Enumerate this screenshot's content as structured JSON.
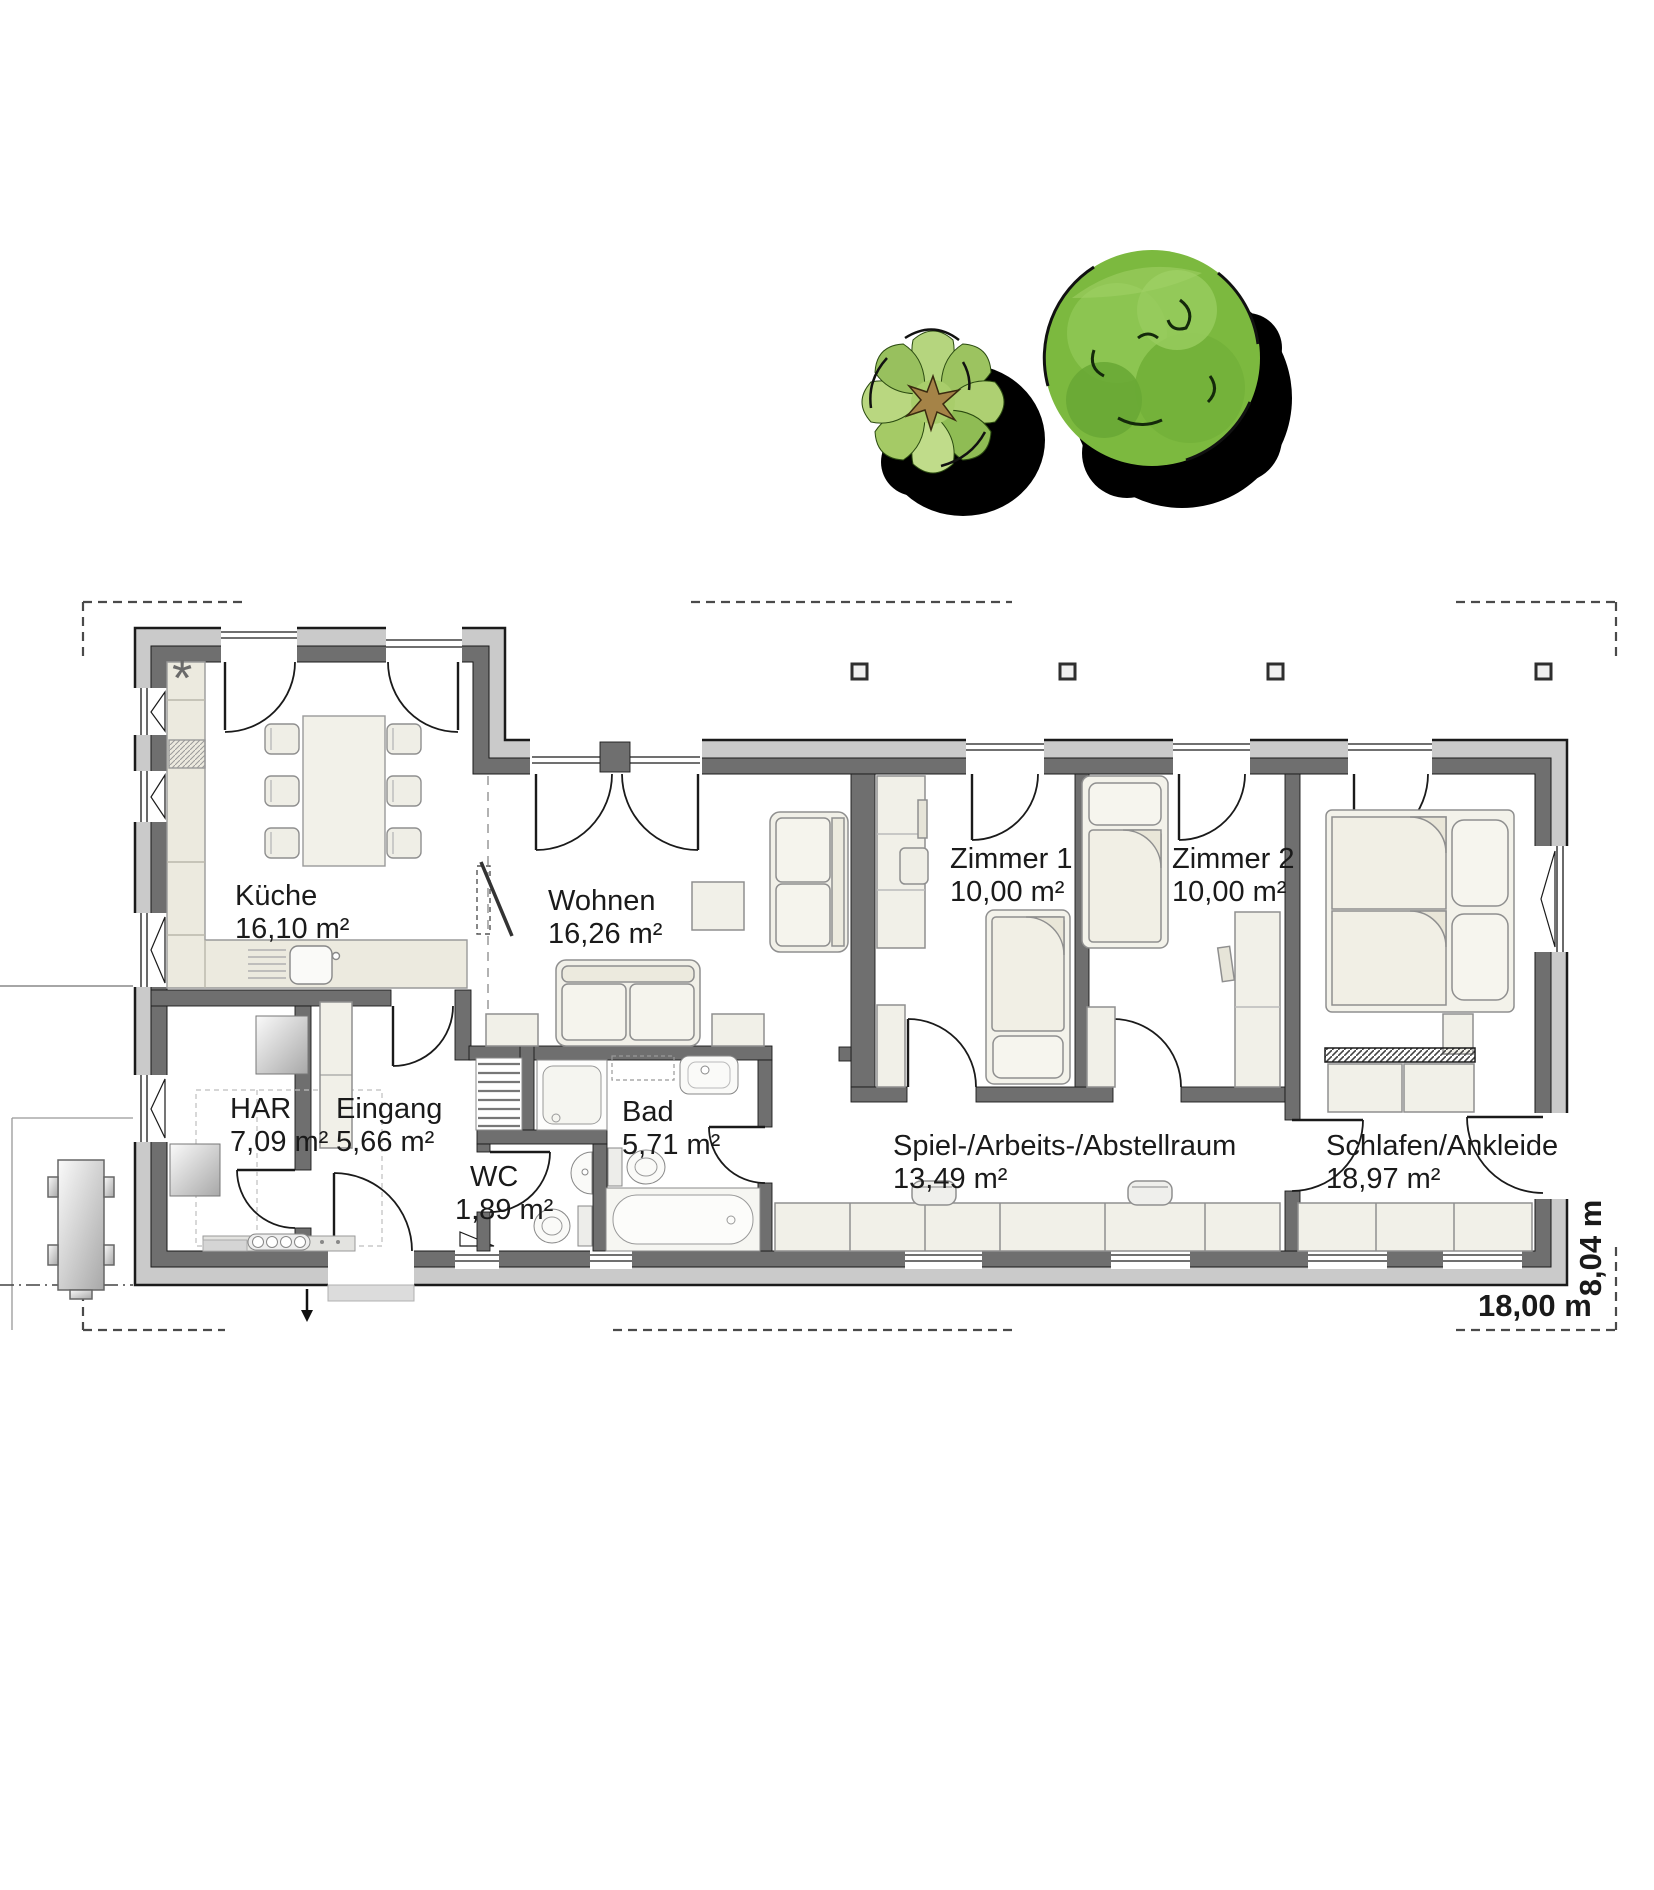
{
  "floorplan": {
    "rooms": [
      {
        "id": "kueche",
        "name": "Küche",
        "area": "16,10 m²"
      },
      {
        "id": "wohnen",
        "name": "Wohnen",
        "area": "16,26 m²"
      },
      {
        "id": "zimmer1",
        "name": "Zimmer 1",
        "area": "10,00 m²"
      },
      {
        "id": "zimmer2",
        "name": "Zimmer 2",
        "area": "10,00 m²"
      },
      {
        "id": "har",
        "name": "HAR",
        "area": "7,09 m²"
      },
      {
        "id": "eingang",
        "name": "Eingang",
        "area": "5,66 m²"
      },
      {
        "id": "wc",
        "name": "WC",
        "area": "1,89 m²"
      },
      {
        "id": "bad",
        "name": "Bad",
        "area": "5,71 m²"
      },
      {
        "id": "spielraum",
        "name": "Spiel-/Arbeits-/Abstellraum",
        "area": "13,49 m²"
      },
      {
        "id": "schlafen",
        "name": "Schlafen/Ankleide",
        "area": "18,97 m²"
      }
    ],
    "dimensions": {
      "width": "18,00 m",
      "depth": "8,04 m"
    },
    "symbols": {
      "kitchen_marker": "*"
    },
    "colors": {
      "wall_outer": "#cacaca",
      "wall_inner": "#6f6f6f",
      "furniture": "#f1f0e8",
      "tree_green": "#7cb93f",
      "tree_light_green": "#aed072",
      "shadow": "#000000"
    }
  }
}
